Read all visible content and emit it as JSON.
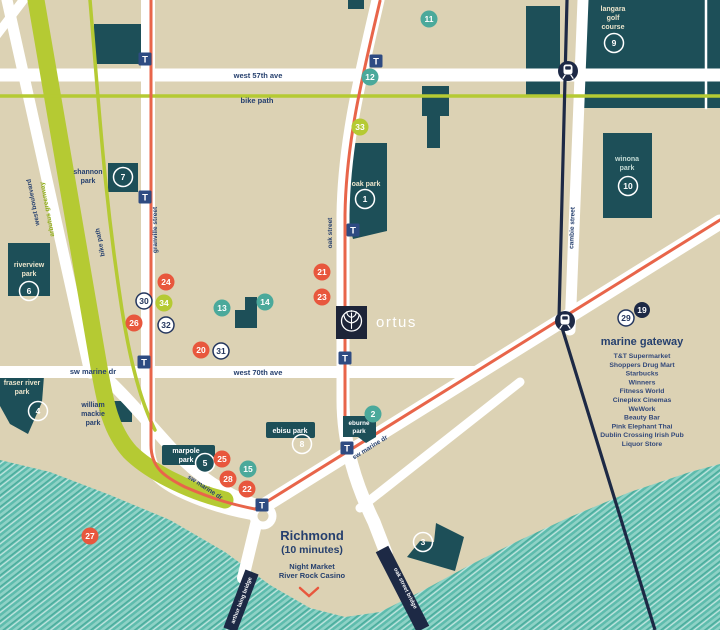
{
  "colors": {
    "background": "#dcd2b4",
    "park_teal": "#1d4f58",
    "water_teal": "#57b9aa",
    "road_white": "#ffffff",
    "bike_lime": "#b5ca33",
    "route_orange": "#e8654a",
    "navy": "#1d2945",
    "transit_blue": "#2e4b82",
    "marker_red": "#e8573d",
    "marker_teal": "#4ba99b",
    "text_navy": "#26406e"
  },
  "streets": {
    "west_57th": "west 57th ave",
    "west_70th": "west 70th ave",
    "sw_marine": "sw marine dr",
    "granville": "granville street",
    "oak": "oak street",
    "cambie": "cambie street",
    "west_blvd": "west boulevard",
    "arbutus": "arbutus greenway",
    "bike_path": "bike path"
  },
  "parks": {
    "shannon": [
      "shannon",
      "park"
    ],
    "oak_park": [
      "oak park"
    ],
    "winona": [
      "winona",
      "park"
    ],
    "langara": [
      "langara",
      "golf",
      "course"
    ],
    "riverview": [
      "riverview",
      "park"
    ],
    "fraser": [
      "fraser river",
      "park"
    ],
    "mackie": [
      "william",
      "mackie",
      "park"
    ],
    "marpole": [
      "marpole",
      "park"
    ],
    "ebisu": [
      "ebisu park"
    ],
    "eburne": [
      "eburne",
      "park"
    ]
  },
  "bridges": {
    "arthur_laing": "arthur laing bridge",
    "oak_bridge": "oak street bridge"
  },
  "logo": "ortus",
  "richmond": {
    "title": "Richmond",
    "subtitle": "(10 minutes)",
    "line1": "Night Market",
    "line2": "River Rock Casino"
  },
  "marine_gateway": {
    "title": "marine gateway",
    "items": [
      "T&T Supermarket",
      "Shoppers Drug Mart",
      "Starbucks",
      "Winners",
      "Fitness World",
      "Cineplex Cinemas",
      "WeWork",
      "Beauty Bar",
      "Pink Elephant Thai",
      "Dublin Crossing Irish Pub",
      "Liquor Store"
    ]
  },
  "transit": {
    "t_label": "T",
    "t_stations": [
      {
        "x": 145,
        "y": 59
      },
      {
        "x": 145,
        "y": 197
      },
      {
        "x": 144,
        "y": 362
      },
      {
        "x": 376,
        "y": 61
      },
      {
        "x": 353,
        "y": 230
      },
      {
        "x": 345,
        "y": 358
      },
      {
        "x": 347,
        "y": 448
      },
      {
        "x": 262,
        "y": 505
      }
    ],
    "train_stations": [
      {
        "x": 568,
        "y": 71
      },
      {
        "x": 565,
        "y": 321
      }
    ]
  },
  "markers": [
    {
      "n": "1",
      "type": "ring",
      "x": 365,
      "y": 199
    },
    {
      "n": "2",
      "type": "teal",
      "x": 373,
      "y": 414
    },
    {
      "n": "3",
      "type": "ring",
      "x": 423,
      "y": 542
    },
    {
      "n": "4",
      "type": "ring",
      "x": 38,
      "y": 411
    },
    {
      "n": "5",
      "type": "dark",
      "x": 205,
      "y": 463
    },
    {
      "n": "6",
      "type": "ring",
      "x": 29,
      "y": 291
    },
    {
      "n": "7",
      "type": "ring",
      "x": 123,
      "y": 177
    },
    {
      "n": "8",
      "type": "ring",
      "x": 302,
      "y": 444
    },
    {
      "n": "9",
      "type": "ring",
      "x": 614,
      "y": 43
    },
    {
      "n": "10",
      "type": "ring",
      "x": 628,
      "y": 186
    },
    {
      "n": "11",
      "type": "teal",
      "x": 429,
      "y": 19
    },
    {
      "n": "12",
      "type": "teal",
      "x": 370,
      "y": 77
    },
    {
      "n": "13",
      "type": "teal",
      "x": 222,
      "y": 308
    },
    {
      "n": "14",
      "type": "teal",
      "x": 265,
      "y": 302
    },
    {
      "n": "15",
      "type": "teal",
      "x": 248,
      "y": 469
    },
    {
      "n": "19",
      "type": "navy",
      "x": 642,
      "y": 310
    },
    {
      "n": "20",
      "type": "red",
      "x": 201,
      "y": 350
    },
    {
      "n": "21",
      "type": "red",
      "x": 322,
      "y": 272
    },
    {
      "n": "22",
      "type": "red",
      "x": 247,
      "y": 489
    },
    {
      "n": "23",
      "type": "red",
      "x": 322,
      "y": 297
    },
    {
      "n": "24",
      "type": "red",
      "x": 166,
      "y": 282
    },
    {
      "n": "25",
      "type": "red",
      "x": 222,
      "y": 459
    },
    {
      "n": "26",
      "type": "red",
      "x": 134,
      "y": 323
    },
    {
      "n": "27",
      "type": "red",
      "x": 90,
      "y": 536
    },
    {
      "n": "28",
      "type": "red",
      "x": 228,
      "y": 479
    },
    {
      "n": "29",
      "type": "white",
      "x": 626,
      "y": 318
    },
    {
      "n": "30",
      "type": "white",
      "x": 144,
      "y": 301
    },
    {
      "n": "31",
      "type": "white",
      "x": 221,
      "y": 351
    },
    {
      "n": "32",
      "type": "white",
      "x": 166,
      "y": 325
    },
    {
      "n": "33",
      "type": "lime",
      "x": 360,
      "y": 127
    },
    {
      "n": "34",
      "type": "lime",
      "x": 164,
      "y": 303
    }
  ]
}
